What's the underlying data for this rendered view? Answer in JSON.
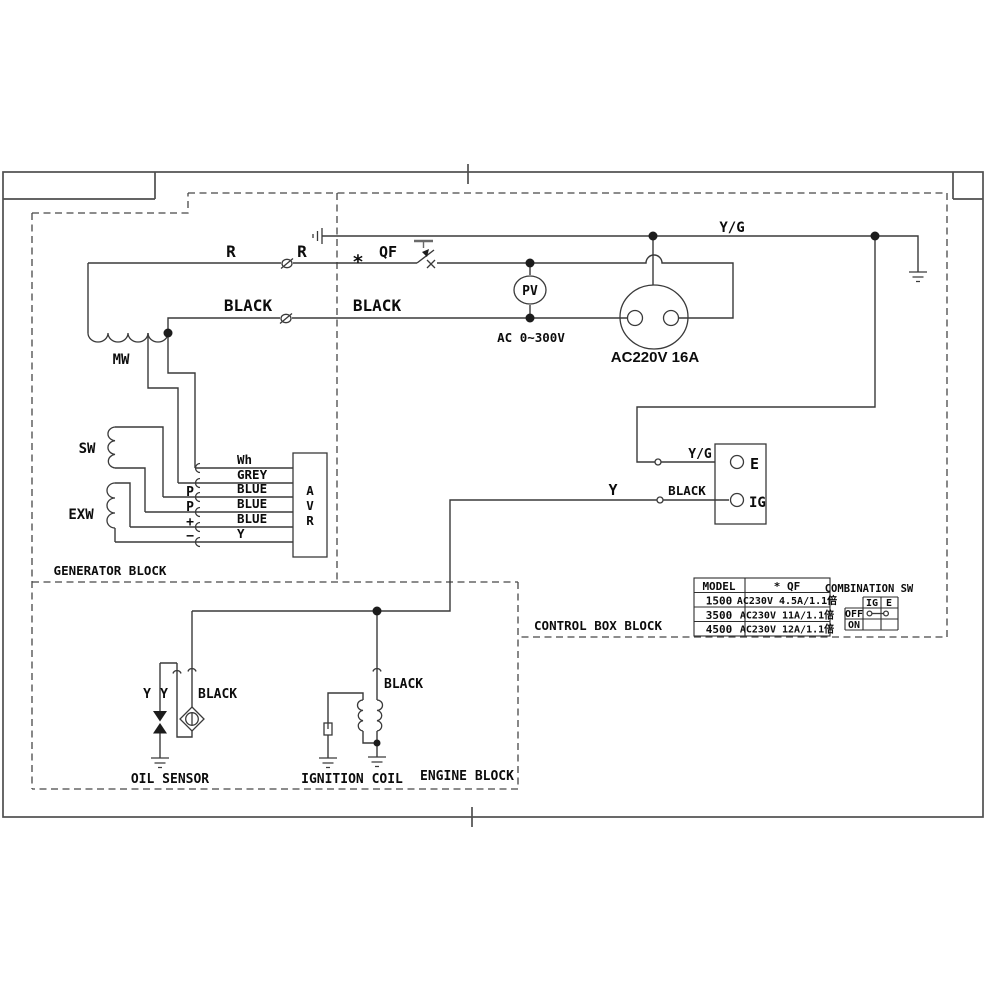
{
  "diagram": {
    "blocks": {
      "generator": "GENERATOR BLOCK",
      "control_box": "CONTROL BOX BLOCK",
      "engine": "ENGINE BLOCK"
    },
    "wires": {
      "r_left": "R",
      "r_right": "R",
      "qf_star": "*",
      "qf": "QF",
      "black_left": "BLACK",
      "black_right": "BLACK",
      "yg_top": "Y/G",
      "yg_e": "Y/G",
      "y_ig": "Y",
      "black_ig": "BLACK",
      "oil_y1": "Y",
      "oil_y2": "Y",
      "oil_black": "BLACK",
      "coil_black": "BLACK"
    },
    "components": {
      "mw": "MW",
      "sw": "SW",
      "exw": "EXW",
      "avr_a": "A",
      "avr_v": "V",
      "avr_r": "R",
      "pv": "PV",
      "pv_range": "AC 0~300V",
      "socket": "AC220V 16A",
      "terminal_e": "E",
      "terminal_ig": "IG",
      "oil_sensor": "OIL SENSOR",
      "ignition_coil": "IGNITION COIL"
    },
    "avr_inputs": {
      "labels": [
        "Wh",
        "GREY",
        "BLUE",
        "BLUE",
        "BLUE",
        "Y"
      ],
      "pins": [
        "P",
        "P",
        "+",
        "−"
      ]
    },
    "model_table": {
      "headers": [
        "MODEL",
        "*  QF"
      ],
      "rows": [
        [
          "1500",
          "AC230V 4.5A/1.1倍"
        ],
        [
          "3500",
          "AC230V 11A/1.1倍"
        ],
        [
          "4500",
          "AC230V 12A/1.1倍"
        ]
      ]
    },
    "combination_sw": {
      "title": "COMBINATION SW",
      "columns": [
        "IG",
        "E"
      ],
      "rows": [
        "OFF",
        "ON"
      ]
    }
  },
  "colors": {
    "background": "#ffffff",
    "line": "#3a3a3a",
    "text": "#0c0c0c"
  }
}
